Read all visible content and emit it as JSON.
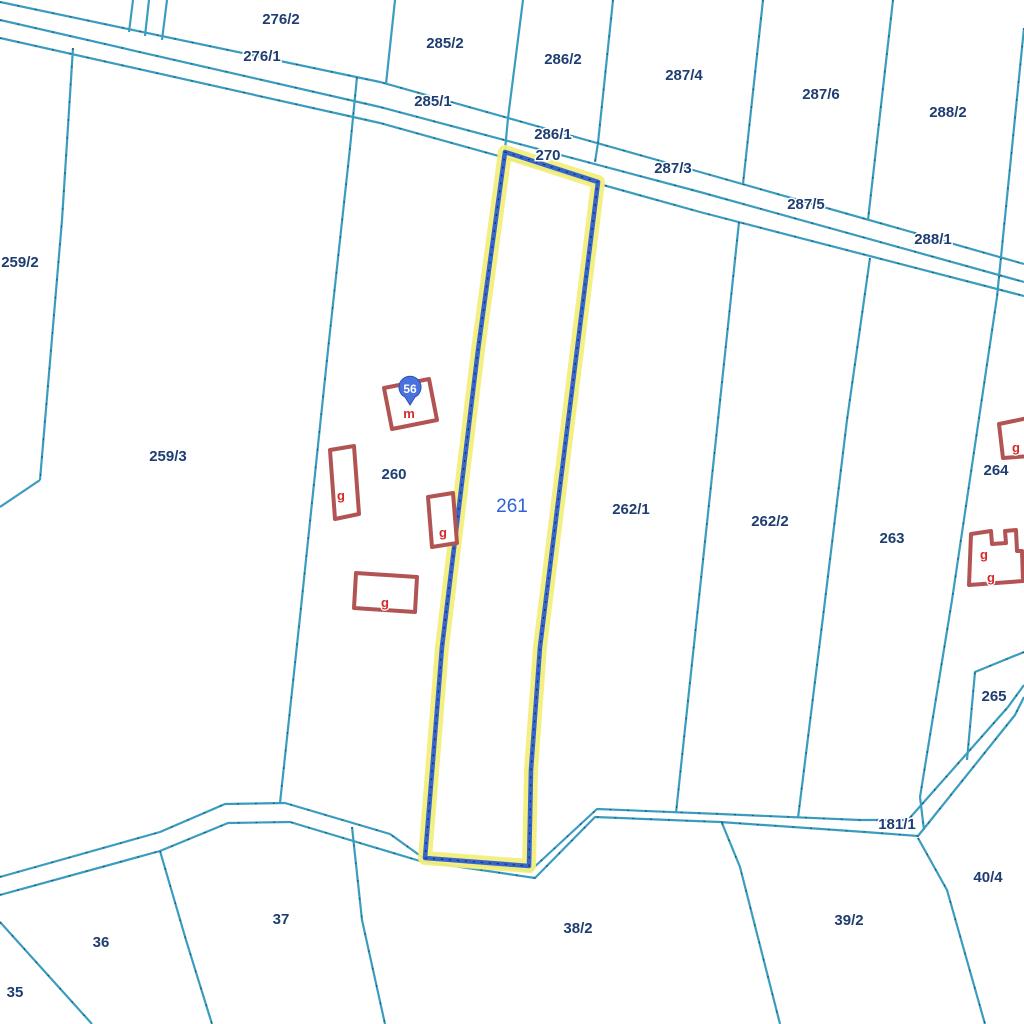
{
  "map": {
    "colors": {
      "background": "#ffffff",
      "boundary_line": "#3a9dbf",
      "boundary_tick": "#16323e",
      "parcel_label": "#1e3d72",
      "label_halo": "#ffffff",
      "selected_parcel_label": "#2f62d8",
      "selected_outline": "#3566cf",
      "selected_highlight": "#f3ee7c",
      "selected_dots": "#1b1b1b",
      "building_outline": "#b25454",
      "building_fill": "#ffffff",
      "building_label": "#d42a2a",
      "marker_fill": "#4a72de",
      "marker_border": "#2d51b5",
      "marker_text": "#ffffff"
    },
    "selected_parcel": {
      "label": "261",
      "x": 512,
      "y": 506
    },
    "parcel_labels": [
      {
        "text": "276/2",
        "x": 281,
        "y": 19
      },
      {
        "text": "276/1",
        "x": 262,
        "y": 56
      },
      {
        "text": "285/2",
        "x": 445,
        "y": 43
      },
      {
        "text": "286/2",
        "x": 563,
        "y": 59
      },
      {
        "text": "287/4",
        "x": 684,
        "y": 75
      },
      {
        "text": "287/6",
        "x": 821,
        "y": 94
      },
      {
        "text": "288/2",
        "x": 948,
        "y": 112
      },
      {
        "text": "285/1",
        "x": 433,
        "y": 101
      },
      {
        "text": "286/1",
        "x": 553,
        "y": 134
      },
      {
        "text": "270",
        "x": 548,
        "y": 155
      },
      {
        "text": "287/3",
        "x": 673,
        "y": 168
      },
      {
        "text": "287/5",
        "x": 806,
        "y": 204
      },
      {
        "text": "288/1",
        "x": 933,
        "y": 239
      },
      {
        "text": "259/2",
        "x": 20,
        "y": 262
      },
      {
        "text": "259/3",
        "x": 168,
        "y": 456
      },
      {
        "text": "260",
        "x": 394,
        "y": 474
      },
      {
        "text": "262/1",
        "x": 631,
        "y": 509
      },
      {
        "text": "262/2",
        "x": 770,
        "y": 521
      },
      {
        "text": "263",
        "x": 892,
        "y": 538
      },
      {
        "text": "264",
        "x": 996,
        "y": 470
      },
      {
        "text": "265",
        "x": 994,
        "y": 696
      },
      {
        "text": "181/1",
        "x": 897,
        "y": 824
      },
      {
        "text": "40/4",
        "x": 988,
        "y": 877
      },
      {
        "text": "39/2",
        "x": 849,
        "y": 920
      },
      {
        "text": "38/2",
        "x": 578,
        "y": 928
      },
      {
        "text": "37",
        "x": 281,
        "y": 919
      },
      {
        "text": "36",
        "x": 101,
        "y": 942
      },
      {
        "text": "35",
        "x": 15,
        "y": 992
      }
    ],
    "building_labels": [
      {
        "text": "g",
        "x": 341,
        "y": 496
      },
      {
        "text": "g",
        "x": 443,
        "y": 533
      },
      {
        "text": "g",
        "x": 385,
        "y": 603
      },
      {
        "text": "g",
        "x": 1016,
        "y": 448
      },
      {
        "text": "g",
        "x": 984,
        "y": 555
      },
      {
        "text": "g",
        "x": 991,
        "y": 578
      },
      {
        "text": "m",
        "x": 409,
        "y": 414
      }
    ],
    "marker": {
      "text": "56",
      "x": 410,
      "y": 389
    }
  }
}
